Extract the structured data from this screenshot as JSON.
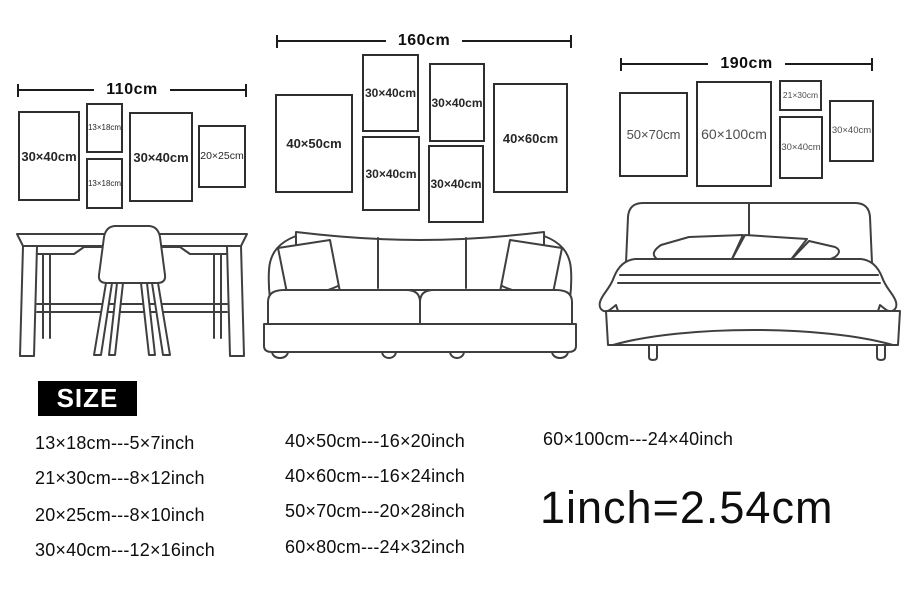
{
  "groups": [
    {
      "id": "desk-wall",
      "width_label": "110cm",
      "frames": [
        {
          "label": "30×40cm"
        },
        {
          "label": "13×18cm"
        },
        {
          "label": "13×18cm"
        },
        {
          "label": "30×40cm"
        },
        {
          "label": "20×25cm"
        }
      ],
      "furniture": "desk-and-chair"
    },
    {
      "id": "sofa-wall",
      "width_label": "160cm",
      "frames": [
        {
          "label": "40×50cm"
        },
        {
          "label": "30×40cm"
        },
        {
          "label": "30×40cm"
        },
        {
          "label": "30×40cm"
        },
        {
          "label": "30×40cm"
        },
        {
          "label": "40×60cm"
        }
      ],
      "furniture": "sofa"
    },
    {
      "id": "bed-wall",
      "width_label": "190cm",
      "frames": [
        {
          "label": "50×70cm"
        },
        {
          "label": "60×100cm"
        },
        {
          "label": "21×30cm"
        },
        {
          "label": "30×40cm"
        },
        {
          "label": "30×40cm"
        }
      ],
      "furniture": "bed"
    }
  ],
  "size_section": {
    "heading": "SIZE",
    "column1": [
      "13×18cm---5×7inch",
      "21×30cm---8×12inch",
      "20×25cm---8×10inch",
      "30×40cm---12×16inch"
    ],
    "column2": [
      "40×50cm---16×20inch",
      "40×60cm---16×24inch",
      "50×70cm---20×28inch",
      "60×80cm---24×32inch"
    ],
    "column3": [
      "60×100cm---24×40inch"
    ],
    "conversion_note": "1inch=2.54cm"
  },
  "colors": {
    "background": "#ffffff",
    "text": "#0e0e0e",
    "frame_border": "#2e2e2e",
    "muted_label": "#4d4d4d",
    "line_art": "#3f3f3f",
    "size_box_bg": "#000000",
    "size_box_text": "#ffffff"
  }
}
